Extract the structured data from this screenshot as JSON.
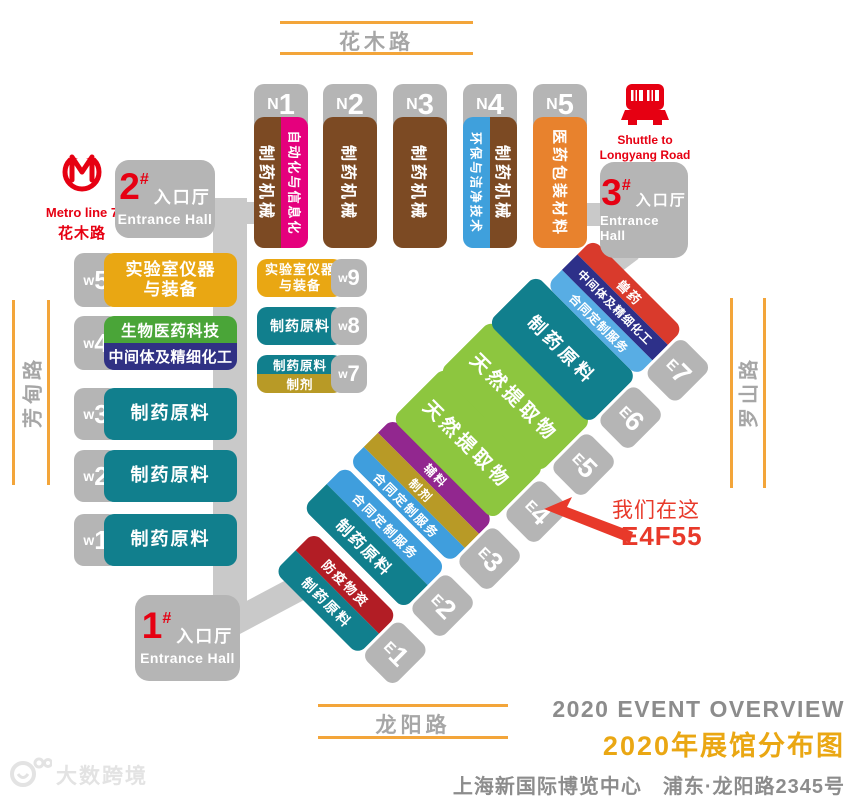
{
  "colors": {
    "road_orange": "#f3a53a",
    "gray_block": "#b5b5b5",
    "gray_connector": "#c9c9c9",
    "accent_red": "#e60012",
    "annotation_red": "#e8392a",
    "brown": "#7c4a23",
    "magenta": "#e5007d",
    "blue": "#3fa0dc",
    "orange": "#e8822d",
    "gold": "#e9a713",
    "green": "#4aa538",
    "navy": "#303184",
    "teal": "#117f8d",
    "lime": "#8dc63f",
    "purple": "#92278f",
    "mustard": "#b89a26",
    "sky_blue": "#3f9edd",
    "sky_blue_light": "#58ade4",
    "bright_red": "#d93a2c",
    "crimson": "#b21d25",
    "title_gray": "#8c8c8c",
    "title_orange": "#eaa713"
  },
  "roads": {
    "top": "花木路",
    "bottom": "龙阳路",
    "left": "芳甸路",
    "right": "罗山路"
  },
  "metro": {
    "line": "Metro line 7",
    "station": "花木路"
  },
  "shuttle": {
    "en_line1": "Shuttle to",
    "en_line2": "Longyang Road",
    "cn": "地铁班车"
  },
  "entrances": {
    "hall1": {
      "num": "1",
      "hash": "#",
      "cn": "入口厅",
      "en": "Entrance Hall"
    },
    "hall2": {
      "num": "2",
      "hash": "#",
      "cn": "入口厅",
      "en": "Entrance Hall"
    },
    "hall3": {
      "num": "3",
      "hash": "#",
      "cn": "入口厅",
      "en": "Entrance Hall"
    }
  },
  "n_halls": [
    {
      "prefix": "N",
      "num": "1",
      "stripes": [
        {
          "label": "制药机械"
        },
        {
          "label": "自动化与信息化"
        }
      ]
    },
    {
      "prefix": "N",
      "num": "2",
      "stripes": [
        {
          "label": "制药机械"
        }
      ]
    },
    {
      "prefix": "N",
      "num": "3",
      "stripes": [
        {
          "label": "制药机械"
        }
      ]
    },
    {
      "prefix": "N",
      "num": "4",
      "stripes": [
        {
          "label": "环保与洁净技术"
        },
        {
          "label": "制药机械"
        }
      ]
    },
    {
      "prefix": "N",
      "num": "5",
      "stripes": [
        {
          "label": "医药包装材料"
        }
      ]
    }
  ],
  "w_main": [
    {
      "prefix": "w",
      "num": "5",
      "lines": [
        "实验室仪器",
        "与装备"
      ]
    },
    {
      "prefix": "w",
      "num": "4",
      "stripes": [
        {
          "label": "生物医药科技"
        },
        {
          "label": "中间体及精细化工"
        }
      ]
    },
    {
      "prefix": "w",
      "num": "3",
      "label": "制药原料"
    },
    {
      "prefix": "w",
      "num": "2",
      "label": "制药原料"
    },
    {
      "prefix": "w",
      "num": "1",
      "label": "制药原料"
    }
  ],
  "w_side": [
    {
      "prefix": "w",
      "num": "9",
      "lines": [
        "实验室仪器",
        "与装备"
      ]
    },
    {
      "prefix": "w",
      "num": "8",
      "label": "制药原料"
    },
    {
      "prefix": "w",
      "num": "7",
      "stripes": [
        {
          "label": "制药原料"
        },
        {
          "label": "制剂"
        }
      ]
    }
  ],
  "e_halls": [
    {
      "prefix": "E",
      "num": "1",
      "stripes": [
        {
          "label": "防疫物资"
        },
        {
          "label": "制药原料"
        }
      ]
    },
    {
      "prefix": "E",
      "num": "2",
      "stripes": [
        {
          "label": "合同定制服务"
        },
        {
          "label": "制药原料"
        }
      ]
    },
    {
      "prefix": "E",
      "num": "3",
      "stripes": [
        {
          "label": "辅料"
        },
        {
          "label": "制剂"
        },
        {
          "label": "合同定制服务"
        }
      ]
    },
    {
      "prefix": "E",
      "num": "4",
      "stripes": [
        {
          "label": "天然提取物"
        }
      ]
    },
    {
      "prefix": "E",
      "num": "5",
      "stripes": [
        {
          "label": "天然提取物"
        }
      ]
    },
    {
      "prefix": "E",
      "num": "6",
      "stripes": [
        {
          "label": "制药原料"
        }
      ]
    },
    {
      "prefix": "E",
      "num": "7",
      "stripes": [
        {
          "label": "兽药"
        },
        {
          "label": "中间体及精细化工"
        },
        {
          "label": "合同定制服务"
        }
      ]
    }
  ],
  "annotation": {
    "line1": "我们在这",
    "line2": "E4F55"
  },
  "footer": {
    "en_title": "2020 EVENT OVERVIEW",
    "cn_title": "2020年展馆分布图",
    "address": "上海新国际博览中心　浦东·龙阳路2345号"
  },
  "watermark": "大数跨境"
}
